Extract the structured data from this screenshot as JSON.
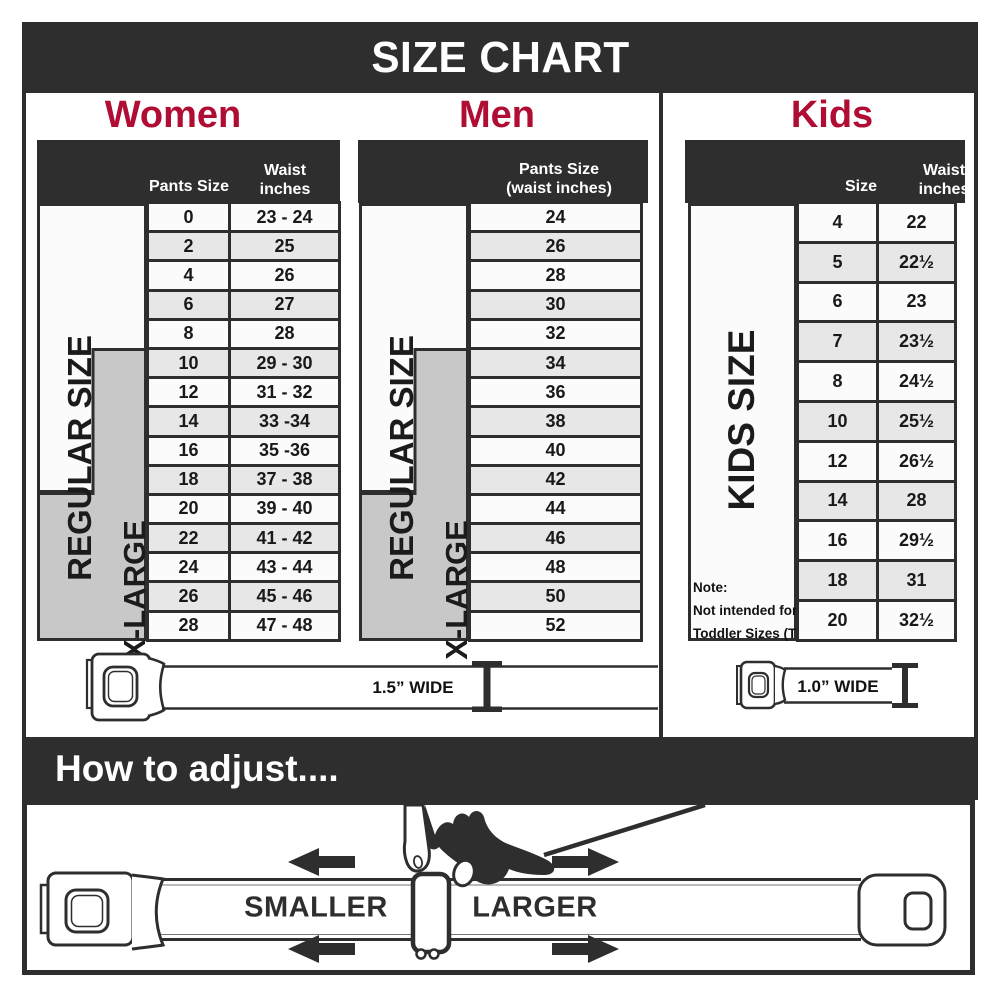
{
  "title": "SIZE CHART",
  "colors": {
    "dark_bar": "#2e2e2e",
    "heading_red": "#b00d35",
    "row_white": "#fbfbfb",
    "row_gray": "#e7e7e7",
    "xlarge_band_gray": "#c8c8c8"
  },
  "women": {
    "heading": "Women",
    "regular_label": "REGULAR SIZE",
    "xlarge_label": "X-LARGE",
    "col_size": "Pants Size",
    "col_waist_line1": "Waist",
    "col_waist_line2": "inches",
    "rows": [
      {
        "size": "0",
        "waist": "23 - 24"
      },
      {
        "size": "2",
        "waist": "25"
      },
      {
        "size": "4",
        "waist": "26"
      },
      {
        "size": "6",
        "waist": "27"
      },
      {
        "size": "8",
        "waist": "28"
      },
      {
        "size": "10",
        "waist": "29 - 30"
      },
      {
        "size": "12",
        "waist": "31 - 32"
      },
      {
        "size": "14",
        "waist": "33 -34"
      },
      {
        "size": "16",
        "waist": "35 -36"
      },
      {
        "size": "18",
        "waist": "37 - 38"
      },
      {
        "size": "20",
        "waist": "39 - 40"
      },
      {
        "size": "22",
        "waist": "41 - 42"
      },
      {
        "size": "24",
        "waist": "43 - 44"
      },
      {
        "size": "26",
        "waist": "45 - 46"
      },
      {
        "size": "28",
        "waist": "47 - 48"
      }
    ],
    "belt_width_label": "1.5” WIDE"
  },
  "men": {
    "heading": "Men",
    "regular_label": "REGULAR SIZE",
    "xlarge_label": "X-LARGE",
    "col_line1": "Pants Size",
    "col_line2": "(waist inches)",
    "rows": [
      "24",
      "26",
      "28",
      "30",
      "32",
      "34",
      "36",
      "38",
      "40",
      "42",
      "44",
      "46",
      "48",
      "50",
      "52"
    ]
  },
  "kids": {
    "heading": "Kids",
    "label": "KIDS SIZE",
    "col_size": "Size",
    "col_waist_line1": "Waist",
    "col_waist_line2": "inches",
    "rows": [
      {
        "size": "4",
        "waist": "22"
      },
      {
        "size": "5",
        "waist": "22½"
      },
      {
        "size": "6",
        "waist": "23"
      },
      {
        "size": "7",
        "waist": "23½"
      },
      {
        "size": "8",
        "waist": "24½"
      },
      {
        "size": "10",
        "waist": "25½"
      },
      {
        "size": "12",
        "waist": "26½"
      },
      {
        "size": "14",
        "waist": "28"
      },
      {
        "size": "16",
        "waist": "29½"
      },
      {
        "size": "18",
        "waist": "31"
      },
      {
        "size": "20",
        "waist": "32½"
      }
    ],
    "note_line1": "Note:",
    "note_line2": "Not intended for",
    "note_line3": "Toddler Sizes (T)",
    "belt_width_label": "1.0” WIDE"
  },
  "adjust": {
    "heading": "How to adjust....",
    "smaller_label": "SMALLER",
    "larger_label": "LARGER"
  }
}
